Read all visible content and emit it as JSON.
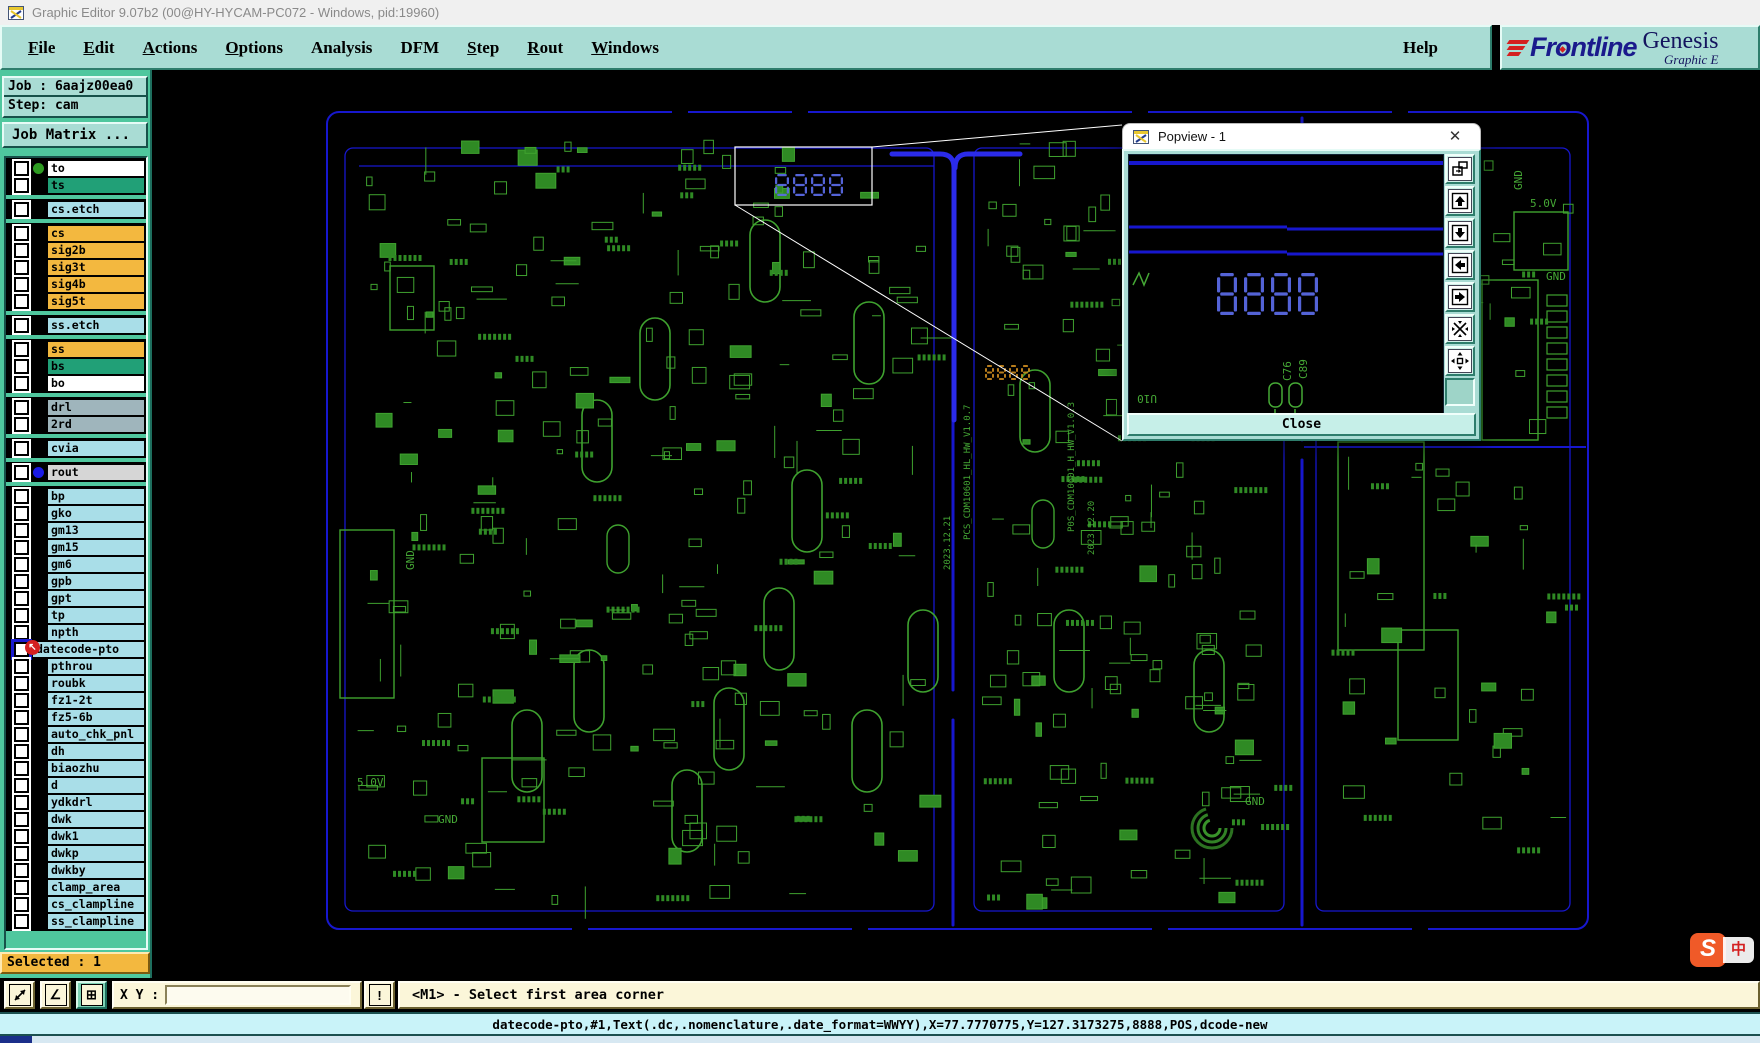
{
  "window": {
    "title": "Graphic Editor 9.07b2 (00@HY-HYCAM-PC072 - Windows, pid:19960)"
  },
  "menu": {
    "items": [
      {
        "label": "File",
        "u": 0
      },
      {
        "label": "Edit",
        "u": 0
      },
      {
        "label": "Actions",
        "u": 0
      },
      {
        "label": "Options",
        "u": 0
      },
      {
        "label": "Analysis",
        "u": -1
      },
      {
        "label": "DFM",
        "u": -1
      },
      {
        "label": "Step",
        "u": 0
      },
      {
        "label": "Rout",
        "u": 0
      },
      {
        "label": "Windows",
        "u": 0
      }
    ],
    "help": {
      "label": "Help",
      "u": -1
    }
  },
  "brand": {
    "company": "Frontline",
    "product": "Genesis",
    "subtitle": "Graphic E"
  },
  "job": {
    "job_line": "Job : 6aajz00ea0",
    "step_line": "Step: cam",
    "matrix_label": "Job Matrix ..."
  },
  "layer_palette": {
    "white": "#FFFFFF",
    "green": "#21A077",
    "cyan": "#A9DEE8",
    "orange": "#F3B83F",
    "gray": "#9FB5BC",
    "lightgray": "#D6D6D6"
  },
  "layers": {
    "groups": [
      {
        "items": [
          {
            "label": "to",
            "bg": "white",
            "dot": "#2E9B22"
          },
          {
            "label": "ts",
            "bg": "green"
          }
        ]
      },
      {
        "items": [
          {
            "label": "cs.etch",
            "bg": "cyan"
          }
        ]
      },
      {
        "items": [
          {
            "label": "cs",
            "bg": "orange"
          },
          {
            "label": "sig2b",
            "bg": "orange"
          },
          {
            "label": "sig3t",
            "bg": "orange"
          },
          {
            "label": "sig4b",
            "bg": "orange"
          },
          {
            "label": "sig5t",
            "bg": "orange"
          }
        ]
      },
      {
        "items": [
          {
            "label": "ss.etch",
            "bg": "cyan"
          }
        ]
      },
      {
        "items": [
          {
            "label": "ss",
            "bg": "orange"
          },
          {
            "label": "bs",
            "bg": "green"
          },
          {
            "label": "bo",
            "bg": "white"
          }
        ]
      },
      {
        "items": [
          {
            "label": "drl",
            "bg": "gray"
          },
          {
            "label": "2rd",
            "bg": "gray"
          }
        ]
      },
      {
        "items": [
          {
            "label": "cvia",
            "bg": "cyan"
          }
        ]
      },
      {
        "items": [
          {
            "label": "rout",
            "bg": "lightgray",
            "dot": "#1A1AE6"
          }
        ]
      },
      {
        "items": [
          {
            "label": "bp",
            "bg": "cyan"
          },
          {
            "label": "gko",
            "bg": "cyan"
          },
          {
            "label": "gm13",
            "bg": "cyan"
          },
          {
            "label": "gm15",
            "bg": "cyan"
          },
          {
            "label": "gm6",
            "bg": "cyan"
          },
          {
            "label": "gpb",
            "bg": "cyan"
          },
          {
            "label": "gpt",
            "bg": "cyan"
          },
          {
            "label": "tp",
            "bg": "cyan"
          },
          {
            "label": "npth",
            "bg": "cyan"
          },
          {
            "label": "datecode-pto",
            "bg": "cyan",
            "selected": true
          },
          {
            "label": "pthrou",
            "bg": "cyan"
          },
          {
            "label": "roubk",
            "bg": "cyan"
          },
          {
            "label": "fz1-2t",
            "bg": "cyan"
          },
          {
            "label": "fz5-6b",
            "bg": "cyan"
          },
          {
            "label": "auto_chk_pnl",
            "bg": "cyan"
          },
          {
            "label": "dh",
            "bg": "cyan"
          },
          {
            "label": "biaozhu",
            "bg": "cyan"
          },
          {
            "label": "d",
            "bg": "cyan"
          },
          {
            "label": "ydkdrl",
            "bg": "cyan"
          },
          {
            "label": "dwk",
            "bg": "cyan"
          },
          {
            "label": "dwk1",
            "bg": "cyan"
          },
          {
            "label": "dwkp",
            "bg": "cyan"
          },
          {
            "label": "dwkby",
            "bg": "cyan"
          },
          {
            "label": "clamp_area",
            "bg": "cyan"
          },
          {
            "label": "cs_clampline",
            "bg": "cyan"
          },
          {
            "label": "ss_clampline",
            "bg": "cyan"
          }
        ]
      }
    ]
  },
  "selected_badge": "Selected : 1",
  "statusbar": {
    "xy_label": "X Y :",
    "xy_value": "",
    "prompt": "<M1> - Select first area corner"
  },
  "command_bar": {
    "text": "datecode-pto,#1,Text(.dc,.nomenclature,.date_format=WWYY),X=77.7770775,Y=127.3173275,8888,POS,dcode-new"
  },
  "popview": {
    "title": "Popview - 1",
    "close_glyph": "✕",
    "close_label": "Close",
    "display_value": "8888",
    "silk_texts": [
      "C89",
      "C76",
      "U10"
    ],
    "tools": [
      "new-popview-icon",
      "move-up-icon",
      "move-down-icon",
      "move-left-icon",
      "move-right-icon",
      "fit-view-icon",
      "pan-view-icon"
    ]
  },
  "canvas": {
    "datecode_selected_value": "8888",
    "datecode_panel2_value": "8888",
    "labels": [
      {
        "text": "5.0V",
        "x": 1378,
        "y": 137
      },
      {
        "text": "GND",
        "x": 1394,
        "y": 210
      },
      {
        "text": "GND",
        "x": 1370,
        "y": 120,
        "rot": -90
      },
      {
        "text": "GND",
        "x": 1093,
        "y": 735
      },
      {
        "text": "GND",
        "x": 286,
        "y": 753
      },
      {
        "text": "5.0V",
        "x": 205,
        "y": 716
      },
      {
        "text": "GND",
        "x": 262,
        "y": 500,
        "rot": -90
      }
    ],
    "vertical_texts": [
      {
        "text": "2023.12.21",
        "x": 798,
        "y": 500
      },
      {
        "text": "PCS_CDM10601_HL_HW_V1.0.7",
        "x": 818,
        "y": 470
      },
      {
        "text": "P0S_CDM10601_H_HW_V1.0.3",
        "x": 922,
        "y": 462
      },
      {
        "text": "2023.12.20",
        "x": 942,
        "y": 485
      }
    ],
    "colors": {
      "board_blue": "#1717CE",
      "slot_blue": "#2B2BEA",
      "silk_green": "#3FA22F",
      "seg_blue": "#5B6BE8",
      "seg_orange": "#C8881E",
      "highlight_white": "#FFFFFF"
    }
  },
  "ime": {
    "letter": "S",
    "char": "中"
  }
}
